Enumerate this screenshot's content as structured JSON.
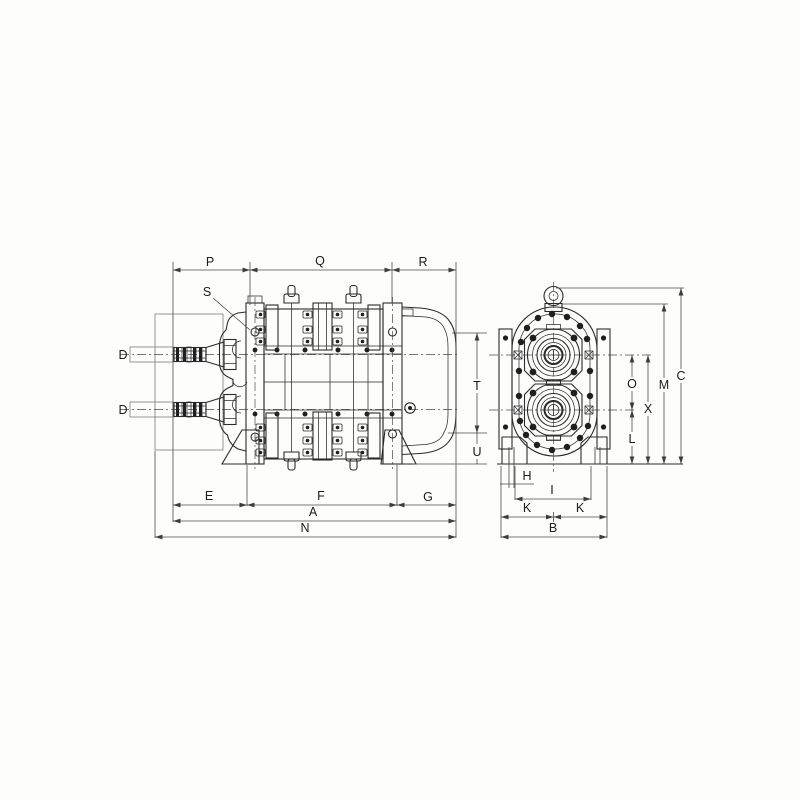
{
  "colors": {
    "ink": "#2b2b2b",
    "dimension_line": "#4a4a4a",
    "paper": "#fdfdfc"
  },
  "side_view": {
    "dims": {
      "p": "P",
      "q": "Q",
      "r": "R",
      "s": "S",
      "d_top": "D",
      "d_bottom": "D",
      "t": "T",
      "u": "U",
      "e": "E",
      "f": "F",
      "g": "G",
      "a": "A",
      "n": "N"
    }
  },
  "end_view": {
    "dims": {
      "o": "O",
      "x": "X",
      "l": "L",
      "m": "M",
      "c": "C",
      "h": "H",
      "i": "I",
      "k_left": "K",
      "k_right": "K",
      "b": "B"
    }
  }
}
